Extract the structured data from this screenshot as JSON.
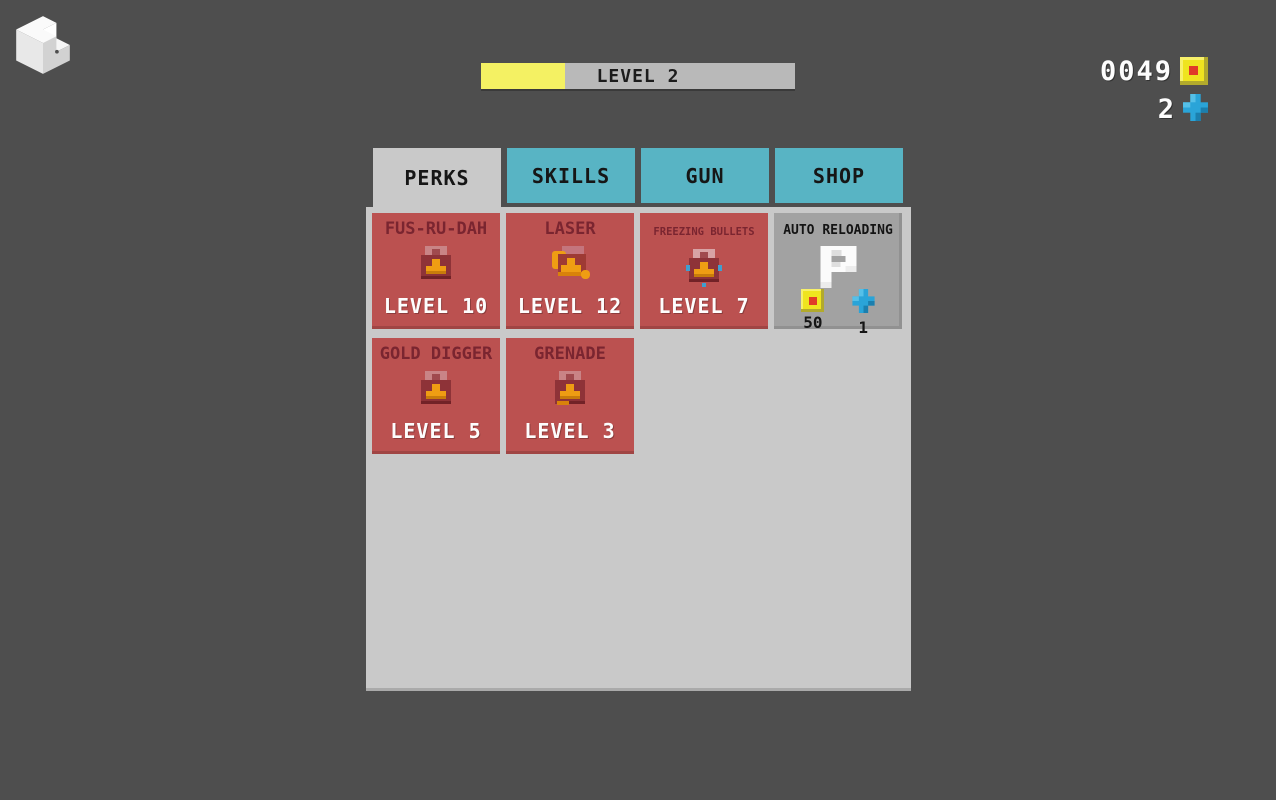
{
  "colors": {
    "background": "#4e4e4e",
    "panel_gray": "#c9c9c9",
    "tab_teal": "#58b4c4",
    "card_red": "#bb5150",
    "card_gray": "#a2a2a2",
    "title_maroon": "#7a2530",
    "bar_fill_yellow": "#f4f163",
    "bar_track_gray": "#b9b9b9",
    "coin_yellow": "#efe41f",
    "cross_blue": "#2aa4d8"
  },
  "logo": {
    "icon": "cube-logo-icon"
  },
  "header": {
    "level_bar": {
      "label": "LEVEL 2",
      "progress_percent": 27,
      "fill_css": "width:26.8%"
    },
    "currencies": [
      {
        "icon": "coin-icon",
        "amount": "0049"
      },
      {
        "icon": "health-cross-icon",
        "amount": "2"
      }
    ]
  },
  "tabs": [
    {
      "label": "PERKS",
      "active": true
    },
    {
      "label": "SKILLS",
      "active": false
    },
    {
      "label": "GUN",
      "active": false
    },
    {
      "label": "SHOP",
      "active": false
    }
  ],
  "perks_panel": {
    "cards": [
      {
        "title": "FUS-RU-DAH",
        "level": "LEVEL 10",
        "icon": "toolbox-icon",
        "state": "owned"
      },
      {
        "title": "LASER",
        "level": "LEVEL 12",
        "icon": "toolbox-laser-icon",
        "state": "owned"
      },
      {
        "title": "FREEZING BULLETS",
        "level": "LEVEL 7",
        "icon": "toolbox-freezing-icon",
        "state": "owned"
      },
      {
        "title": "AUTO RELOADING",
        "icon": "letter-a-icon",
        "state": "purchasable",
        "cost": {
          "coins": "50",
          "crosses": "1"
        }
      },
      {
        "title": "GOLD DIGGER",
        "level": "LEVEL 5",
        "icon": "toolbox-icon",
        "state": "owned"
      },
      {
        "title": "GRENADE",
        "level": "LEVEL 3",
        "icon": "toolbox-icon",
        "state": "owned"
      }
    ]
  }
}
